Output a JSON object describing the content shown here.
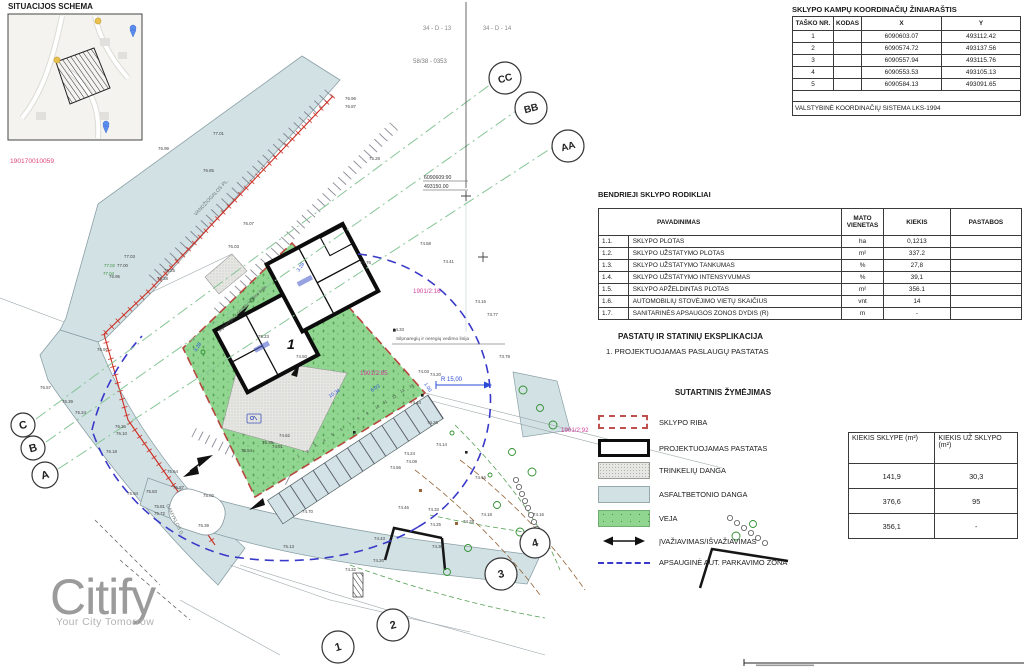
{
  "situation": {
    "title": "SITUACIJOS SCHEMA",
    "code": "190170010059"
  },
  "coord_table": {
    "title": "SKLYPO KAMPŲ KOORDINAČIŲ ŽINIARAŠTIS",
    "headers": [
      "TAŠKO NR.",
      "KODAS",
      "X",
      "Y"
    ],
    "rows": [
      [
        "1",
        "",
        "6090603.07",
        "493112.42"
      ],
      [
        "2",
        "",
        "6090574.72",
        "493137.56"
      ],
      [
        "3",
        "",
        "6090557.94",
        "493115.76"
      ],
      [
        "4",
        "",
        "6090553.53",
        "493105.13"
      ],
      [
        "5",
        "",
        "6090584.13",
        "493091.65"
      ]
    ],
    "footer": "VALSTYBINĖ KOORDINAČIŲ SISTEMA LKS-1994"
  },
  "indicators": {
    "title": "BENDRIEJI SKLYPO RODIKLIAI",
    "headers": [
      "PAVADINIMAS",
      "MATO VIENETAS",
      "KIEKIS",
      "PASTABOS"
    ],
    "rows": [
      [
        "1.1.",
        "SKLYPO PLOTAS",
        "ha",
        "0,1213",
        ""
      ],
      [
        "1.2.",
        "SKLYPO UŽSTATYMO PLOTAS",
        "m²",
        "337.2",
        ""
      ],
      [
        "1.3.",
        "SKLYPO UŽSTATYMO TANKUMAS",
        "%",
        "27,8",
        ""
      ],
      [
        "1.4.",
        "SKLYPO UŽSTATYMO INTENSYVUMAS",
        "%",
        "39,1",
        ""
      ],
      [
        "1.5.",
        "SKLYPO APŽELDINTAS PLOTAS",
        "m²",
        "356.1",
        ""
      ],
      [
        "1.6.",
        "AUTOMOBILIŲ STOVĖJIMO VIETŲ SKAIČIUS",
        "vnt",
        "14",
        ""
      ],
      [
        "1.7.",
        "SANITARINĖS APSAUGOS ZONOS DYDIS (R)",
        "m",
        "-",
        ""
      ]
    ]
  },
  "explication": {
    "title": "PASTATŲ IR STATINIŲ EKSPLIKACIJA",
    "item": "1.  PROJEKTUOJAMAS PASLAUGŲ PASTATAS"
  },
  "legend": {
    "title": "SUTARTINIS ŽYMĖJIMAS",
    "items": [
      {
        "label": "SKLYPO RIBA"
      },
      {
        "label": "PROJEKTUOJAMAS PASTATAS"
      },
      {
        "label": "TRINKELIŲ DANGA"
      },
      {
        "label": "ASFALTBETONIO DANGA"
      },
      {
        "label": "VEJA"
      },
      {
        "label": "ĮVAŽIAVIMAS/IŠVAŽIAVIMAS"
      },
      {
        "label": "APSAUGINĖ AUT. PARKAVIMO ZONA"
      }
    ]
  },
  "quantities": {
    "headers": [
      "KIEKIS SKLYPE (m²)",
      "KIEKIS UŽ SKLYPO (m²)"
    ],
    "rows": [
      [
        "141,9",
        "30,3"
      ],
      [
        "376,6",
        "95"
      ],
      [
        "356,1",
        "-"
      ]
    ]
  },
  "logo": {
    "name": "Citify",
    "tagline": "Your City Tomorrow"
  },
  "colors": {
    "asphalt": "#d2e1e4",
    "veja": "#90d690",
    "boundary_red": "#b8473e",
    "zone_blue": "#3939c9",
    "magenta": "#cf3e9b",
    "section_green": "#86c596"
  },
  "plan": {
    "circles": [
      {
        "l": "C",
        "x": 23,
        "y": 425,
        "r": 12
      },
      {
        "l": "B",
        "x": 33,
        "y": 448,
        "r": 12
      },
      {
        "l": "A",
        "x": 45,
        "y": 475,
        "r": 13
      },
      {
        "l": "CC",
        "x": 505,
        "y": 78,
        "r": 16
      },
      {
        "l": "BB",
        "x": 531,
        "y": 108,
        "r": 16
      },
      {
        "l": "AA",
        "x": 568,
        "y": 146,
        "r": 16
      },
      {
        "l": "1",
        "x": 338,
        "y": 647,
        "r": 16
      },
      {
        "l": "2",
        "x": 393,
        "y": 625,
        "r": 16
      },
      {
        "l": "3",
        "x": 501,
        "y": 574,
        "r": 16
      },
      {
        "l": "4",
        "x": 535,
        "y": 543,
        "r": 15
      }
    ],
    "labels": [
      {
        "t": "34 - D - 13",
        "x": 437,
        "y": 30,
        "s": 6,
        "c": "#8a8a8a",
        "a": "middle"
      },
      {
        "t": "34 - D - 14",
        "x": 497,
        "y": 30,
        "s": 6,
        "c": "#8a8a8a",
        "a": "middle"
      },
      {
        "t": "58/38 - 0353",
        "x": 430,
        "y": 63,
        "s": 6,
        "c": "#7a7a7a",
        "a": "middle"
      },
      {
        "t": "6090609:90",
        "x": 424,
        "y": 179,
        "s": 5.2,
        "c": "#333"
      },
      {
        "t": "493150.00",
        "x": 424,
        "y": 188,
        "s": 5.2,
        "c": "#333"
      },
      {
        "t": "1901/2:16",
        "x": 413,
        "y": 293,
        "s": 6.2,
        "c": "#cf3e9b"
      },
      {
        "t": "1901/2:85",
        "x": 360,
        "y": 375,
        "s": 6.2,
        "c": "#cf3e9b"
      },
      {
        "t": "1901/2:92",
        "x": 561,
        "y": 432,
        "s": 6.2,
        "c": "#cf3e9b"
      },
      {
        "t": "VANDŽIOGALOS PL.",
        "x": 196,
        "y": 216,
        "s": 5,
        "c": "#6a7a7a",
        "r": -47
      },
      {
        "t": "GAMYKLOS G.",
        "x": 166,
        "y": 505,
        "s": 5,
        "c": "#6a7a7a",
        "r": 64
      },
      {
        "t": "Silpnaregių ir neregių vedimo linija",
        "x": 396,
        "y": 340,
        "s": 4.8,
        "c": "#555"
      },
      {
        "t": "Silpnaregių ir neregių vedimo linija",
        "x": 243,
        "y": 310,
        "s": 4.3,
        "c": "#555",
        "r": -44,
        "a": "middle"
      },
      {
        "t": "R 15,00",
        "x": 441,
        "y": 381,
        "s": 6,
        "c": "#2b4bd7"
      },
      {
        "t": "3.28",
        "x": 299,
        "y": 272,
        "s": 5,
        "c": "#2b4bd7",
        "r": -56
      },
      {
        "t": "3.28",
        "x": 196,
        "y": 352,
        "s": 5,
        "c": "#2b4bd7",
        "r": -56
      },
      {
        "t": "10.34",
        "x": 330,
        "y": 398,
        "s": 5,
        "c": "#2b4bd7",
        "r": -33
      },
      {
        "t": "6.03",
        "x": 372,
        "y": 392,
        "s": 5,
        "c": "#2b4bd7",
        "r": -33
      },
      {
        "t": "1.00",
        "x": 424,
        "y": 384,
        "s": 5,
        "c": "#2b4bd7",
        "r": 57
      },
      {
        "t": "1",
        "x": 287,
        "y": 349,
        "s": 14,
        "c": "#111",
        "b": 1,
        "it": 1
      },
      {
        "t": "77.01",
        "x": 213,
        "y": 135
      },
      {
        "t": "76.99",
        "x": 158,
        "y": 150
      },
      {
        "t": "76.96",
        "x": 345,
        "y": 100
      },
      {
        "t": "76.87",
        "x": 345,
        "y": 108
      },
      {
        "t": "76.85",
        "x": 203,
        "y": 172
      },
      {
        "t": "77.03",
        "x": 124,
        "y": 258
      },
      {
        "t": "77.00",
        "x": 117,
        "y": 267
      },
      {
        "t": "76.95",
        "x": 109,
        "y": 278
      },
      {
        "t": "76.97",
        "x": 97,
        "y": 351
      },
      {
        "t": "77.02",
        "x": 104,
        "y": 267,
        "c": "#3a8f3a"
      },
      {
        "t": "77.04",
        "x": 103,
        "y": 275,
        "c": "#3a8f3a"
      },
      {
        "t": "76.07",
        "x": 243,
        "y": 225
      },
      {
        "t": "76.03",
        "x": 228,
        "y": 248
      },
      {
        "t": "76.25",
        "x": 164,
        "y": 272
      },
      {
        "t": "76.38",
        "x": 157,
        "y": 280
      },
      {
        "t": "75.28",
        "x": 369,
        "y": 160
      },
      {
        "t": "76.57",
        "x": 40,
        "y": 389
      },
      {
        "t": "76.39",
        "x": 62,
        "y": 403
      },
      {
        "t": "76.24",
        "x": 75,
        "y": 414
      },
      {
        "t": "76.18",
        "x": 106,
        "y": 453
      },
      {
        "t": "76.36",
        "x": 115,
        "y": 428
      },
      {
        "t": "76.10",
        "x": 116,
        "y": 435
      },
      {
        "t": "75.94",
        "x": 127,
        "y": 495
      },
      {
        "t": "75.83",
        "x": 146,
        "y": 493
      },
      {
        "t": "75.81",
        "x": 154,
        "y": 508
      },
      {
        "t": "75.72",
        "x": 154,
        "y": 515
      },
      {
        "t": "75.87",
        "x": 173,
        "y": 489
      },
      {
        "t": "75.64",
        "x": 167,
        "y": 473
      },
      {
        "t": "75.39",
        "x": 198,
        "y": 527
      },
      {
        "t": "75.02",
        "x": 203,
        "y": 497
      },
      {
        "t": "75.23",
        "x": 258,
        "y": 338
      },
      {
        "t": "74.50",
        "x": 296,
        "y": 358
      },
      {
        "t": "74.76",
        "x": 360,
        "y": 264
      },
      {
        "t": "74.58",
        "x": 420,
        "y": 245
      },
      {
        "t": "74.41",
        "x": 443,
        "y": 263
      },
      {
        "t": "74.33",
        "x": 393,
        "y": 331
      },
      {
        "t": "73.77",
        "x": 487,
        "y": 316
      },
      {
        "t": "74.16",
        "x": 475,
        "y": 303
      },
      {
        "t": "74.20",
        "x": 430,
        "y": 376
      },
      {
        "t": "74.03",
        "x": 418,
        "y": 373
      },
      {
        "t": "74.44",
        "x": 410,
        "y": 404
      },
      {
        "t": "74.26",
        "x": 427,
        "y": 424
      },
      {
        "t": "74.14",
        "x": 436,
        "y": 446
      },
      {
        "t": "74.24",
        "x": 404,
        "y": 455
      },
      {
        "t": "74.08",
        "x": 406,
        "y": 463
      },
      {
        "t": "74.56",
        "x": 390,
        "y": 469
      },
      {
        "t": "74.70",
        "x": 302,
        "y": 513
      },
      {
        "t": "74.46",
        "x": 398,
        "y": 509
      },
      {
        "t": "74.33",
        "x": 428,
        "y": 511
      },
      {
        "t": "74.16",
        "x": 475,
        "y": 479
      },
      {
        "t": "73.78",
        "x": 499,
        "y": 358
      },
      {
        "t": "74.91",
        "x": 272,
        "y": 448
      },
      {
        "t": "74.62",
        "x": 279,
        "y": 437
      },
      {
        "t": "75.39",
        "x": 262,
        "y": 444
      },
      {
        "t": "75.54",
        "x": 241,
        "y": 452
      },
      {
        "t": "74.43",
        "x": 374,
        "y": 540
      },
      {
        "t": "74.25",
        "x": 430,
        "y": 526
      },
      {
        "t": "74.30",
        "x": 432,
        "y": 548
      },
      {
        "t": "74.20",
        "x": 373,
        "y": 562
      },
      {
        "t": "74.32",
        "x": 345,
        "y": 571
      },
      {
        "t": "75.13",
        "x": 283,
        "y": 548
      },
      {
        "t": "74.28",
        "x": 463,
        "y": 523
      },
      {
        "t": "74.18",
        "x": 481,
        "y": 516
      },
      {
        "t": "74.16",
        "x": 533,
        "y": 516
      },
      {
        "t": "1",
        "x": 298,
        "y": 458,
        "s": 3.8,
        "r": -30
      },
      {
        "t": "2",
        "x": 307,
        "y": 453,
        "s": 3.8,
        "r": -30
      },
      {
        "t": "3",
        "x": 315,
        "y": 447,
        "s": 3.8,
        "r": -30
      },
      {
        "t": "4",
        "x": 324,
        "y": 442,
        "s": 3.8,
        "r": -30
      },
      {
        "t": "5",
        "x": 332,
        "y": 436,
        "s": 3.8,
        "r": -30
      },
      {
        "t": "6",
        "x": 341,
        "y": 431,
        "s": 3.8,
        "r": -30
      },
      {
        "t": "7",
        "x": 350,
        "y": 426,
        "s": 3.8,
        "r": -30
      },
      {
        "t": "8",
        "x": 358,
        "y": 420,
        "s": 3.8,
        "r": -30
      },
      {
        "t": "9",
        "x": 367,
        "y": 415,
        "s": 3.8,
        "r": -30
      },
      {
        "t": "10",
        "x": 376,
        "y": 409,
        "s": 3.8,
        "r": -30
      },
      {
        "t": "11",
        "x": 384,
        "y": 404,
        "s": 3.8,
        "r": -30
      },
      {
        "t": "12",
        "x": 393,
        "y": 399,
        "s": 3.8,
        "r": -30
      },
      {
        "t": "13",
        "x": 401,
        "y": 393,
        "s": 3.8,
        "r": -30
      },
      {
        "t": "14",
        "x": 410,
        "y": 388,
        "s": 3.8,
        "r": -30
      }
    ]
  }
}
